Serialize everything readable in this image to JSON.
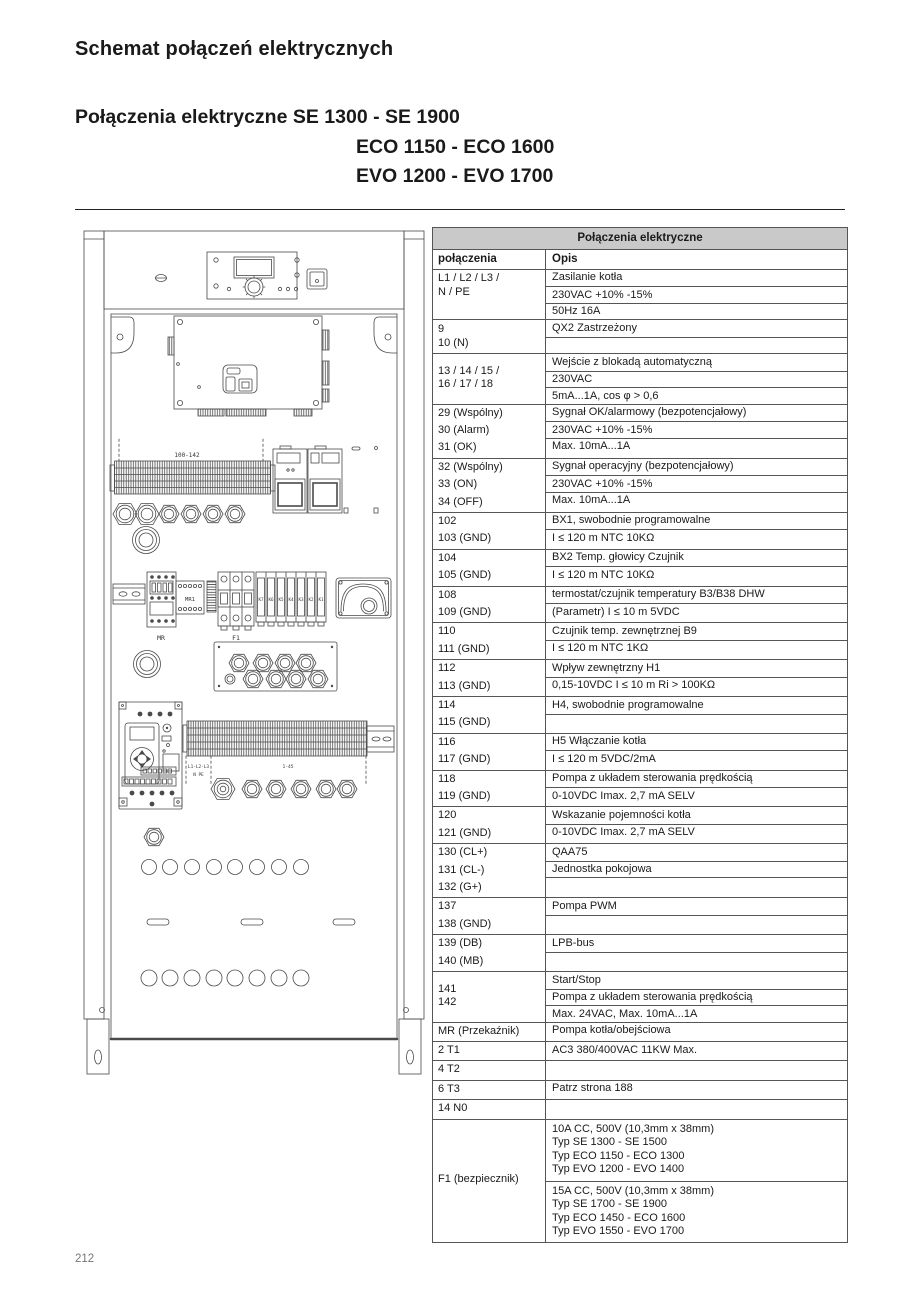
{
  "header": {
    "title": "Schemat połączeń elektrycznych",
    "subtitle_line1": "Połączenia elektryczne SE 1300 - SE 1900",
    "subtitle_line2": "ECO 1150 - ECO 1600",
    "subtitle_line3": "EVO 1200 - EVO 1700"
  },
  "table": {
    "title": "Połączenia elektryczne",
    "col1": "połączenia",
    "col2": "Opis",
    "header_bg": "#c9c9c9",
    "groups": [
      {
        "left": "L1 / L2 /  L3 /\nN /  PE",
        "mode": "top",
        "rows": [
          "Zasilanie kotła",
          "230VAC +10% -15%",
          "50Hz 16A"
        ]
      },
      {
        "left": "9\n10 (N)",
        "mode": "top",
        "rows": [
          "QX2 Zastrzeżony",
          ""
        ]
      },
      {
        "left": "13 / 14 / 15 /\n16 / 17  / 18",
        "mode": "middle",
        "rows": [
          "Wejście z blokadą automatyczną",
          "230VAC",
          "5mA...1A, cos φ > 0,6"
        ]
      },
      {
        "left": "29  (Wspólny)\n30  (Alarm)\n31  (OK)",
        "mode": "rows",
        "rows": [
          "Sygnał OK/alarmowy (bezpotencjałowy)",
          "230VAC +10% -15%",
          "Max. 10mA...1A"
        ]
      },
      {
        "left": "32  (Wspólny)\n33  (ON)\n34  (OFF)",
        "mode": "rows",
        "rows": [
          "Sygnał operacyjny (bezpotencjałowy)",
          "230VAC +10% -15%",
          "Max. 10mA...1A"
        ]
      },
      {
        "left": "102\n103 (GND)",
        "mode": "rows",
        "rows": [
          "BX1, swobodnie programowalne",
          "I ≤ 120 m  NTC 10KΩ"
        ]
      },
      {
        "left": "104\n105 (GND)",
        "mode": "rows",
        "rows": [
          "BX2 Temp. głowicy Czujnik",
          "I ≤ 120 m  NTC 10KΩ"
        ]
      },
      {
        "left": "108\n109 (GND)",
        "mode": "rows",
        "rows": [
          "termostat/czujnik temperatury B3/B38 DHW",
          "(Parametr) I ≤ 10 m 5VDC"
        ]
      },
      {
        "left": "110\n111 (GND)",
        "mode": "rows",
        "rows": [
          "Czujnik temp. zewnętrznej B9",
          "I ≤ 120 m  NTC 1KΩ"
        ]
      },
      {
        "left": "112\n113 (GND)",
        "mode": "rows",
        "rows": [
          "Wpływ zewnętrzny H1",
          "0,15-10VDC I ≤ 10 m Ri > 100KΩ"
        ]
      },
      {
        "left": "114\n115 (GND)",
        "mode": "rows",
        "rows": [
          "H4, swobodnie programowalne",
          ""
        ]
      },
      {
        "left": "116\n117 (GND)",
        "mode": "rows",
        "rows": [
          "H5 Włączanie kotła",
          "I ≤ 120 m 5VDC/2mA"
        ]
      },
      {
        "left": "118\n119 (GND)",
        "mode": "rows",
        "rows": [
          "Pompa z układem sterowania prędkością",
          "0-10VDC Imax. 2,7 mA SELV"
        ]
      },
      {
        "left": "120\n121 (GND)",
        "mode": "rows",
        "rows": [
          "Wskazanie pojemności kotła",
          "0-10VDC Imax. 2,7 mA SELV"
        ]
      },
      {
        "left": "130 (CL+)\n131 (CL-)\n132 (G+)",
        "mode": "rows",
        "rows": [
          "QAA75",
          "Jednostka pokojowa",
          ""
        ]
      },
      {
        "left": "137\n138 (GND)",
        "mode": "rows",
        "rows": [
          "Pompa PWM",
          ""
        ]
      },
      {
        "left": "139 (DB)\n140 (MB)",
        "mode": "rows",
        "rows": [
          "LPB-bus",
          ""
        ]
      },
      {
        "left": "141\n142",
        "mode": "middle",
        "rows": [
          "Start/Stop",
          "Pompa z układem sterowania prędkością",
          "Max. 24VAC, Max. 10mA...1A"
        ]
      },
      {
        "left": "MR (Przekaźnik)",
        "mode": "rows",
        "rows": [
          "Pompa kotła/obejściowa"
        ]
      },
      {
        "left": "2 T1",
        "mode": "rows",
        "rows": [
          "AC3 380/400VAC 11KW Max."
        ]
      },
      {
        "left": "4 T2",
        "mode": "rows",
        "rows": [
          ""
        ]
      },
      {
        "left": "6 T3",
        "mode": "rows",
        "rows": [
          "Patrz strona 188"
        ]
      },
      {
        "left": "14 N0",
        "mode": "rows",
        "rows": [
          ""
        ]
      },
      {
        "left": "F1 (bezpiecznik)",
        "mode": "middle",
        "tall": true,
        "rows": [
          "10A CC, 500V (10,3mm x 38mm)\nTyp SE 1300 - SE 1500\nTyp ECO 1150 - ECO 1300\nTyp EVO 1200 - EVO 1400",
          "15A CC, 500V  (10,3mm x 38mm)\nTyp SE 1700 - SE 1900\nTyp ECO 1450 - ECO 1600\nTyp EVO 1550 - EVO 1700"
        ]
      }
    ]
  },
  "diagram": {
    "strip_label": "100-142",
    "mr_label": "MR",
    "mr1_label": "MR1",
    "f1_label": "F1",
    "k_labels": [
      "K7",
      "K6",
      "K5",
      "K4",
      "K3",
      "K2",
      "K1"
    ],
    "mains_label": "L1-L2-L3",
    "npe_label": "N PE",
    "strip2_label": "1-45"
  },
  "footer": {
    "page_number": "212"
  }
}
